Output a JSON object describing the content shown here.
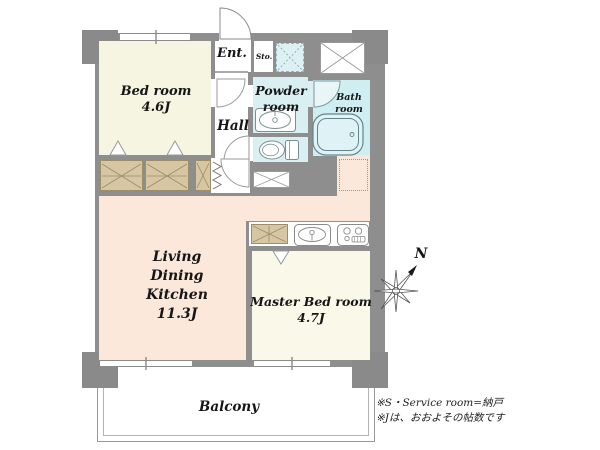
{
  "rooms": {
    "bedroom": {
      "name": "Bed room",
      "size": "4.6J"
    },
    "living_dining_kitchen": {
      "name": "Living Dining Kitchen",
      "size": "11.3J"
    },
    "master_bedroom": {
      "name": "Master Bed room",
      "size": "4.7J"
    },
    "hall": {
      "name": "Hall"
    },
    "entrance": {
      "name": "Ent."
    },
    "storage": {
      "name": "Sto."
    },
    "powder_room": {
      "name": "Powder room"
    },
    "bath_room": {
      "name": "Bath room"
    },
    "balcony": {
      "name": "Balcony"
    }
  },
  "compass": {
    "north_label": "N"
  },
  "notes": {
    "line1": "※S・Service room=納戸",
    "line2": "※Jは、おおよその帖数です"
  },
  "fixtures": [
    "bathtub",
    "washbasin",
    "toilet",
    "kitchen-sink",
    "gas-stove",
    "washing-machine-space",
    "pipe-space",
    "refrigerator-space",
    "floor-access-hatch",
    "closet",
    "accordion-door"
  ],
  "colors": {
    "wall": "#8e8e8e",
    "bedroom_floor": "#f6f5e2",
    "master_bedroom_floor": "#f9f8e9",
    "ldk_floor": "#fbe8db",
    "wet_area": "#d9eff2",
    "closet": "#d6c6a2",
    "balcony_line": "#9a9a9a"
  }
}
